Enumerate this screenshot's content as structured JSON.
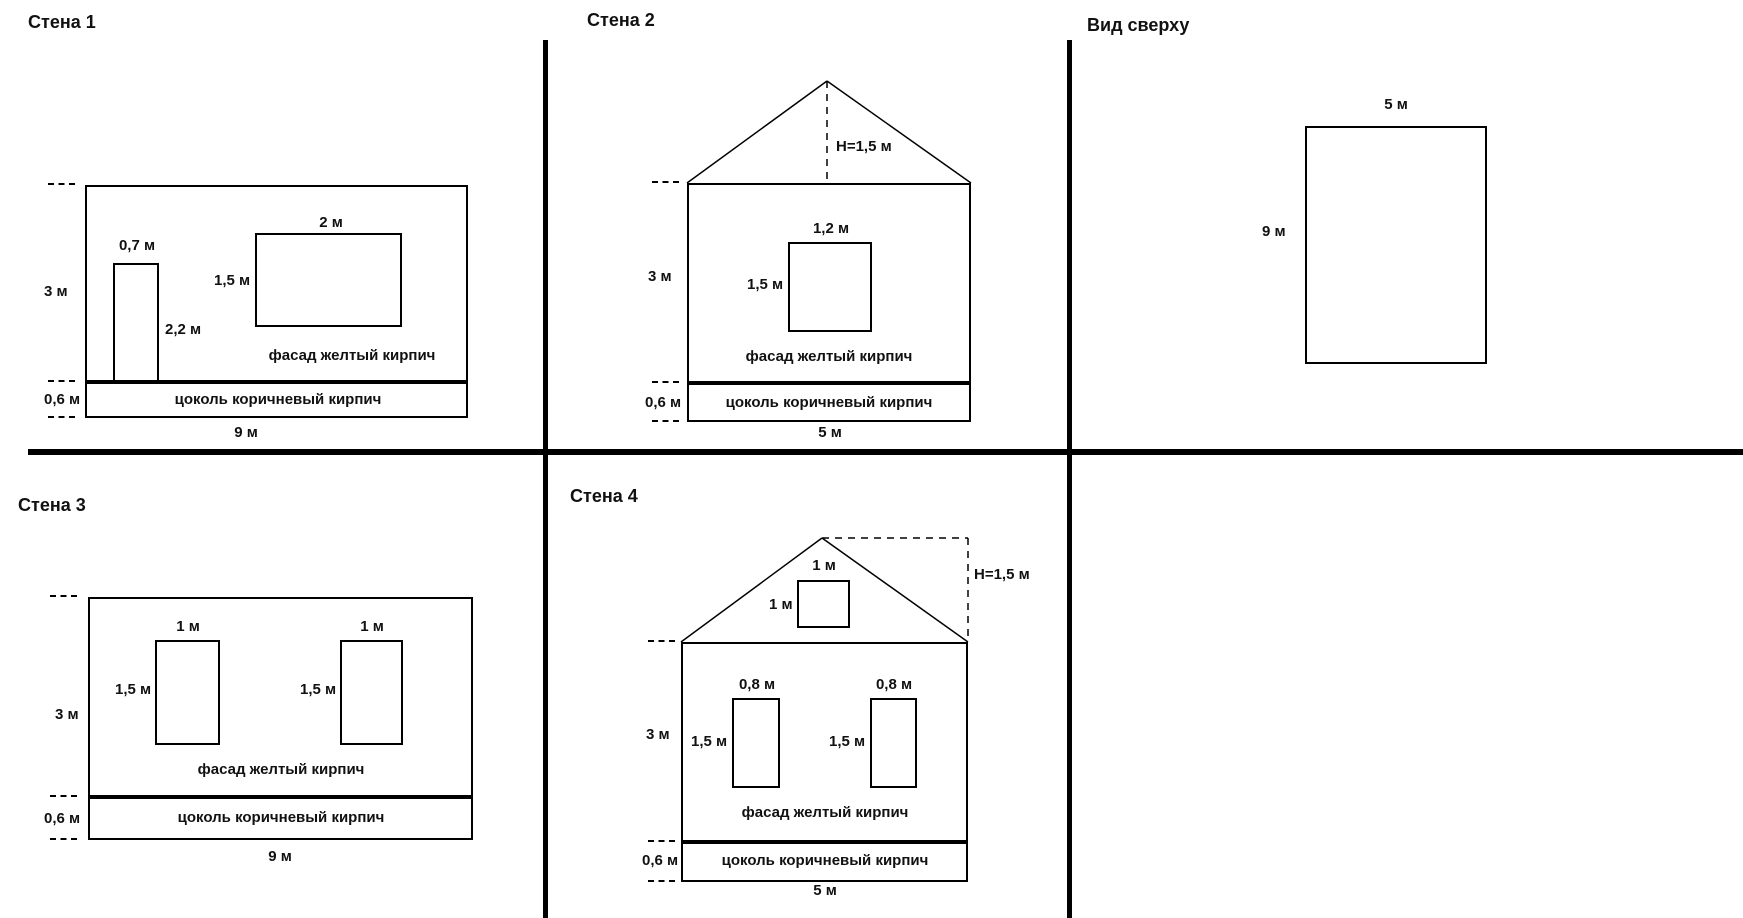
{
  "colors": {
    "line": "#000000",
    "background": "#ffffff",
    "text": "#111111"
  },
  "panels": {
    "wall1": {
      "title": "Стена 1",
      "height_label": "3 м",
      "plinth_height_label": "0,6 м",
      "width_label": "9 м",
      "door": {
        "width_label": "0,7 м",
        "height_label": "2,2 м"
      },
      "window": {
        "width_label": "2 м",
        "height_label": "1,5 м"
      },
      "facade_label": "фасад желтый кирпич",
      "plinth_label": "цоколь коричневый кирпич"
    },
    "wall2": {
      "title": "Стена 2",
      "roof_height_label": "H=1,5 м",
      "height_label": "3 м",
      "plinth_height_label": "0,6 м",
      "width_label": "5 м",
      "window": {
        "width_label": "1,2 м",
        "height_label": "1,5 м"
      },
      "facade_label": "фасад желтый кирпич",
      "plinth_label": "цоколь коричневый кирпич"
    },
    "top_view": {
      "title": "Вид сверху",
      "width_label": "5 м",
      "depth_label": "9 м"
    },
    "wall3": {
      "title": "Стена 3",
      "height_label": "3 м",
      "plinth_height_label": "0,6 м",
      "width_label": "9 м",
      "window1": {
        "width_label": "1 м",
        "height_label": "1,5 м"
      },
      "window2": {
        "width_label": "1 м",
        "height_label": "1,5 м"
      },
      "facade_label": "фасад желтый кирпич",
      "plinth_label": "цоколь коричневый кирпич"
    },
    "wall4": {
      "title": "Стена 4",
      "roof_height_label": "H=1,5 м",
      "gable_window": {
        "width_label": "1 м",
        "height_label": "1 м"
      },
      "height_label": "3 м",
      "plinth_height_label": "0,6 м",
      "width_label": "5 м",
      "window1": {
        "width_label": "0,8 м",
        "height_label": "1,5 м"
      },
      "window2": {
        "width_label": "0,8 м",
        "height_label": "1,5 м"
      },
      "facade_label": "фасад желтый кирпич",
      "plinth_label": "цоколь коричневый кирпич"
    }
  }
}
